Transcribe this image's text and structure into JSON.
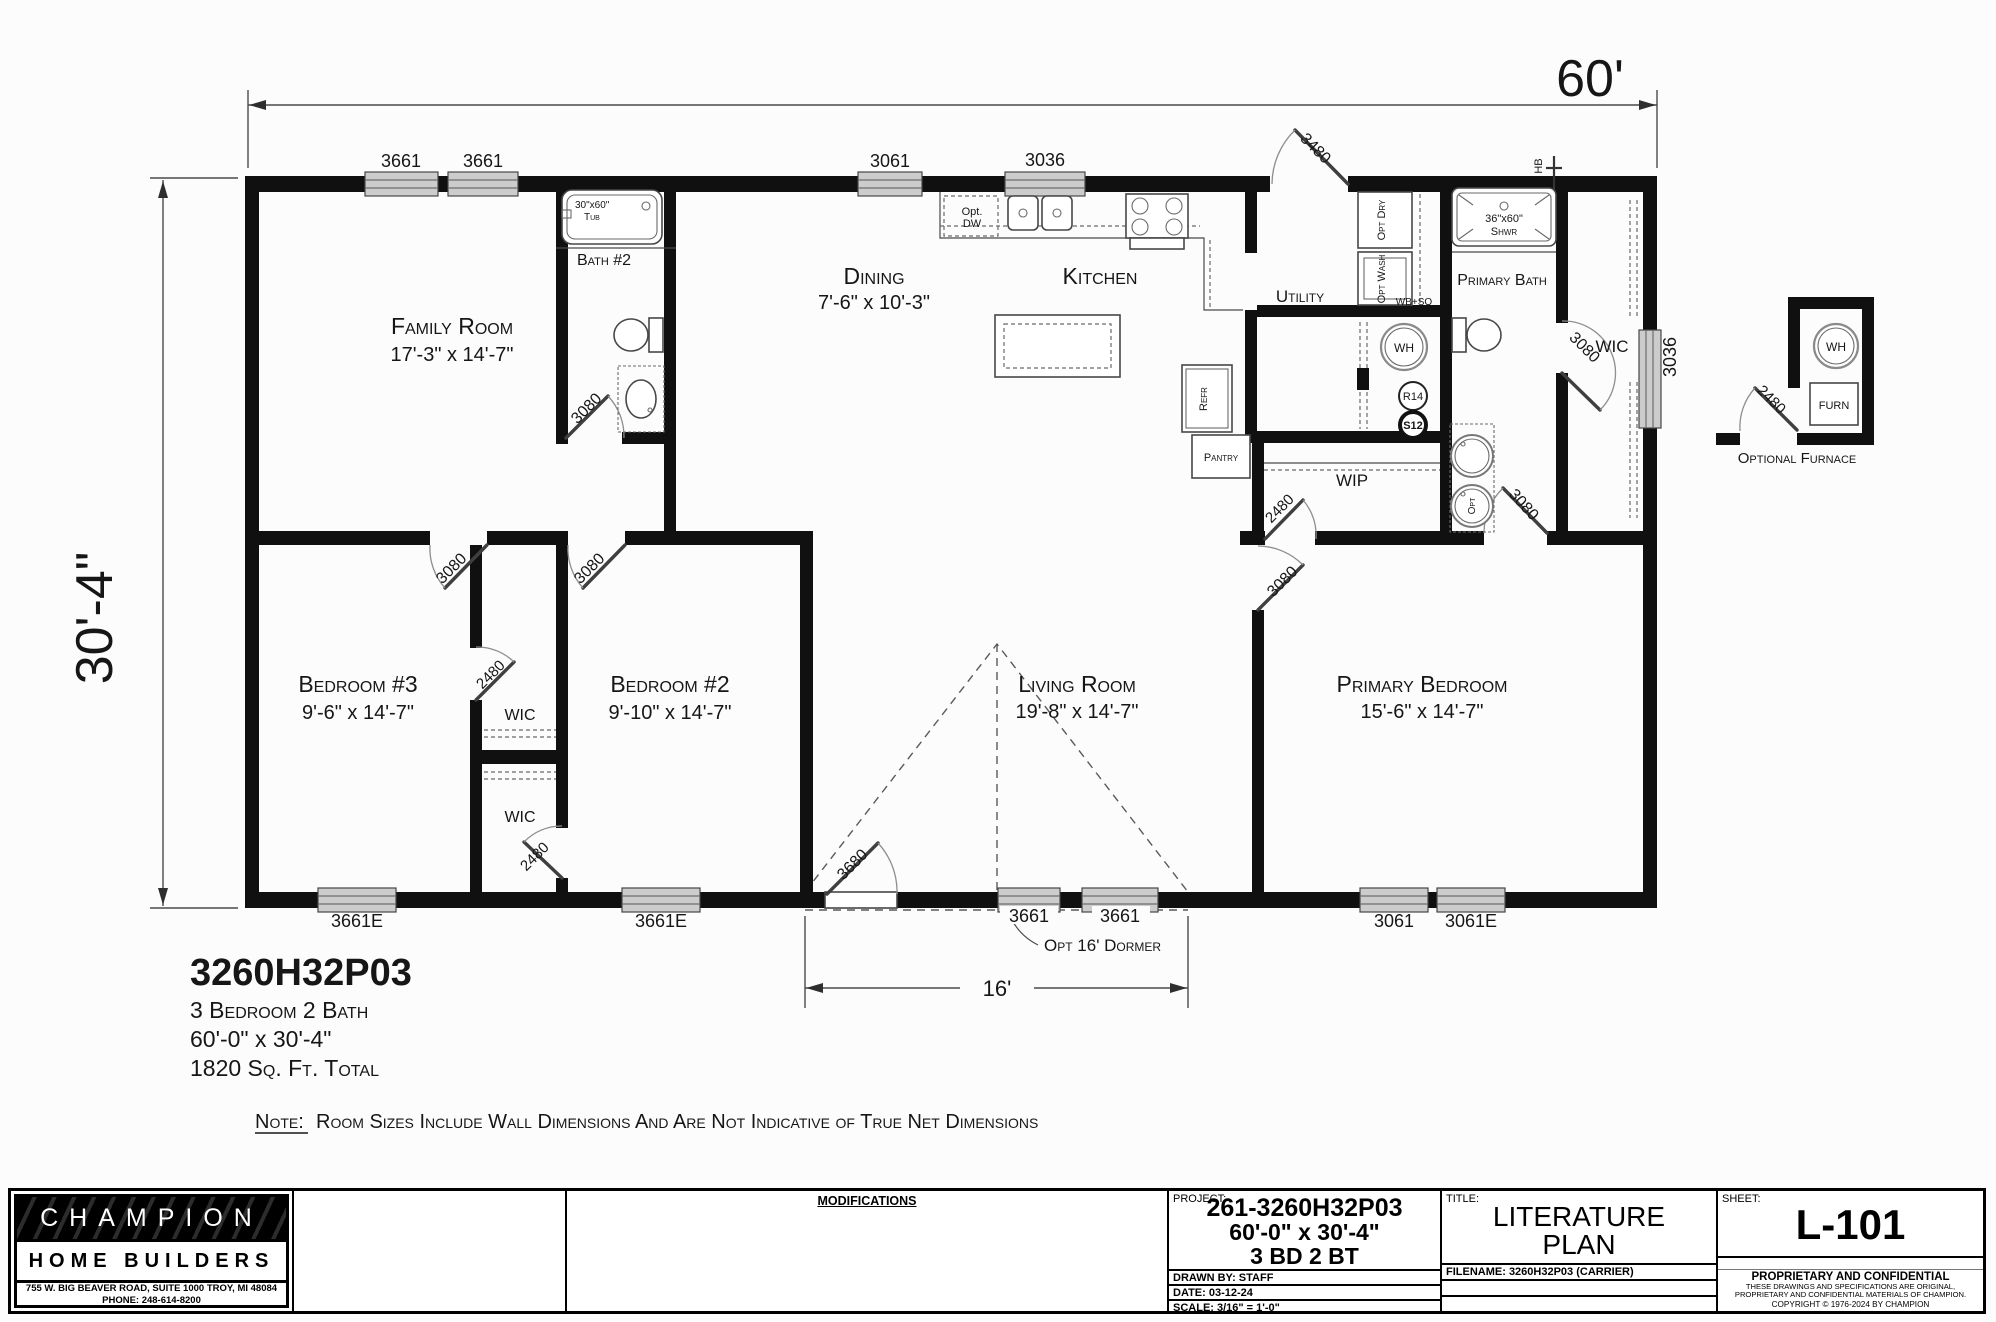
{
  "dims": {
    "width": "60'",
    "height": "30'-4\"",
    "dormer": "16'",
    "dormer_note": "Opt 16' Dormer"
  },
  "info": {
    "model": "3260H32P03",
    "type": "3 Bedroom 2 Bath",
    "size": "60'-0\" x 30'-4\"",
    "area": "1820 Sq. Ft. Total",
    "note_label": "Note:",
    "note": "Room Sizes Include Wall Dimensions And Are Not Indicative of True Net Dimensions"
  },
  "rooms": {
    "family": {
      "name": "Family Room",
      "dims": "17'-3\" x 14'-7\""
    },
    "bath2": {
      "name": "Bath #2"
    },
    "dining": {
      "name": "Dining",
      "dims": "7'-6\" x 10'-3\""
    },
    "kitchen": {
      "name": "Kitchen"
    },
    "utility": {
      "name": "Utility"
    },
    "pbath": {
      "name": "Primary Bath"
    },
    "wic_pb": {
      "name": "WIC"
    },
    "wip": {
      "name": "WIP"
    },
    "bed3": {
      "name": "Bedroom #3",
      "dims": "9'-6\" x 14'-7\""
    },
    "bed2": {
      "name": "Bedroom #2",
      "dims": "9'-10\" x 14'-7\""
    },
    "living": {
      "name": "Living Room",
      "dims": "19'-8\" x 14'-7\""
    },
    "pbed": {
      "name": "Primary Bedroom",
      "dims": "15'-6\" x 14'-7\""
    },
    "wic3": {
      "name": "WIC"
    },
    "wic2": {
      "name": "WIC"
    }
  },
  "fixtures": {
    "tub_size": "30\"x60\"",
    "tub": "Tub",
    "shwr_size": "36\"x60\"",
    "shwr": "Shwr",
    "dw1": "Opt.",
    "dw2": "DW",
    "dry": "Opt Dry",
    "wash": "Opt Wash",
    "wbso": "WB+SO",
    "wh": "WH",
    "r14": "R14",
    "s12": "S12",
    "refr": "Refr",
    "pantry": "Pantry",
    "furn": "FURN",
    "opt": "Opt",
    "hb": "HB"
  },
  "doors": {
    "rear": "3480",
    "bath2": "3080",
    "bed3": "3080",
    "bed2": "3080",
    "wic3": "2480",
    "wic2": "2480",
    "living": "3680",
    "wip": "2480",
    "pbed": "3080",
    "pbath": "3080",
    "pwic": "3080",
    "furnace": "2480"
  },
  "windows": {
    "t1": "3661",
    "t2": "3661",
    "t3": "3061",
    "t4": "3036",
    "b1": "3661E",
    "b2": "3661E",
    "b3": "3661",
    "b4": "3661",
    "b5": "3061",
    "b6": "3061E",
    "r1": "3036"
  },
  "detail": {
    "label": "Optional Furnace"
  },
  "tb": {
    "logo": {
      "name1": "CHAMPION",
      "name2": "HOME BUILDERS",
      "addr": "755 W. BIG BEAVER ROAD, SUITE 1000  TROY, MI  48084",
      "phone": "PHONE: 248-614-8200"
    },
    "mods": "MODIFICATIONS",
    "project": {
      "label": "PROJECT:",
      "num": "261-3260H32P03",
      "size": "60'-0\" x 30'-4\"",
      "bd": "3 BD 2 BT",
      "drawn": "DRAWN BY: STAFF",
      "date": "DATE: 03-12-24",
      "scale": "SCALE: 3/16\" = 1'-0\""
    },
    "title": {
      "label": "TITLE:",
      "line1": "LITERATURE",
      "line2": "PLAN",
      "filename": "FILENAME: 3260H32P03 (CARRIER)"
    },
    "sheet": {
      "label": "SHEET:",
      "num": "L-101",
      "prop1": "PROPRIETARY AND CONFIDENTIAL",
      "prop2": "THESE DRAWINGS AND SPECIFICATIONS ARE ORIGINAL,",
      "prop3": "PROPRIETARY AND CONFIDENTIAL MATERIALS OF CHAMPION.",
      "prop4": "COPYRIGHT © 1976-2024 BY CHAMPION"
    }
  }
}
